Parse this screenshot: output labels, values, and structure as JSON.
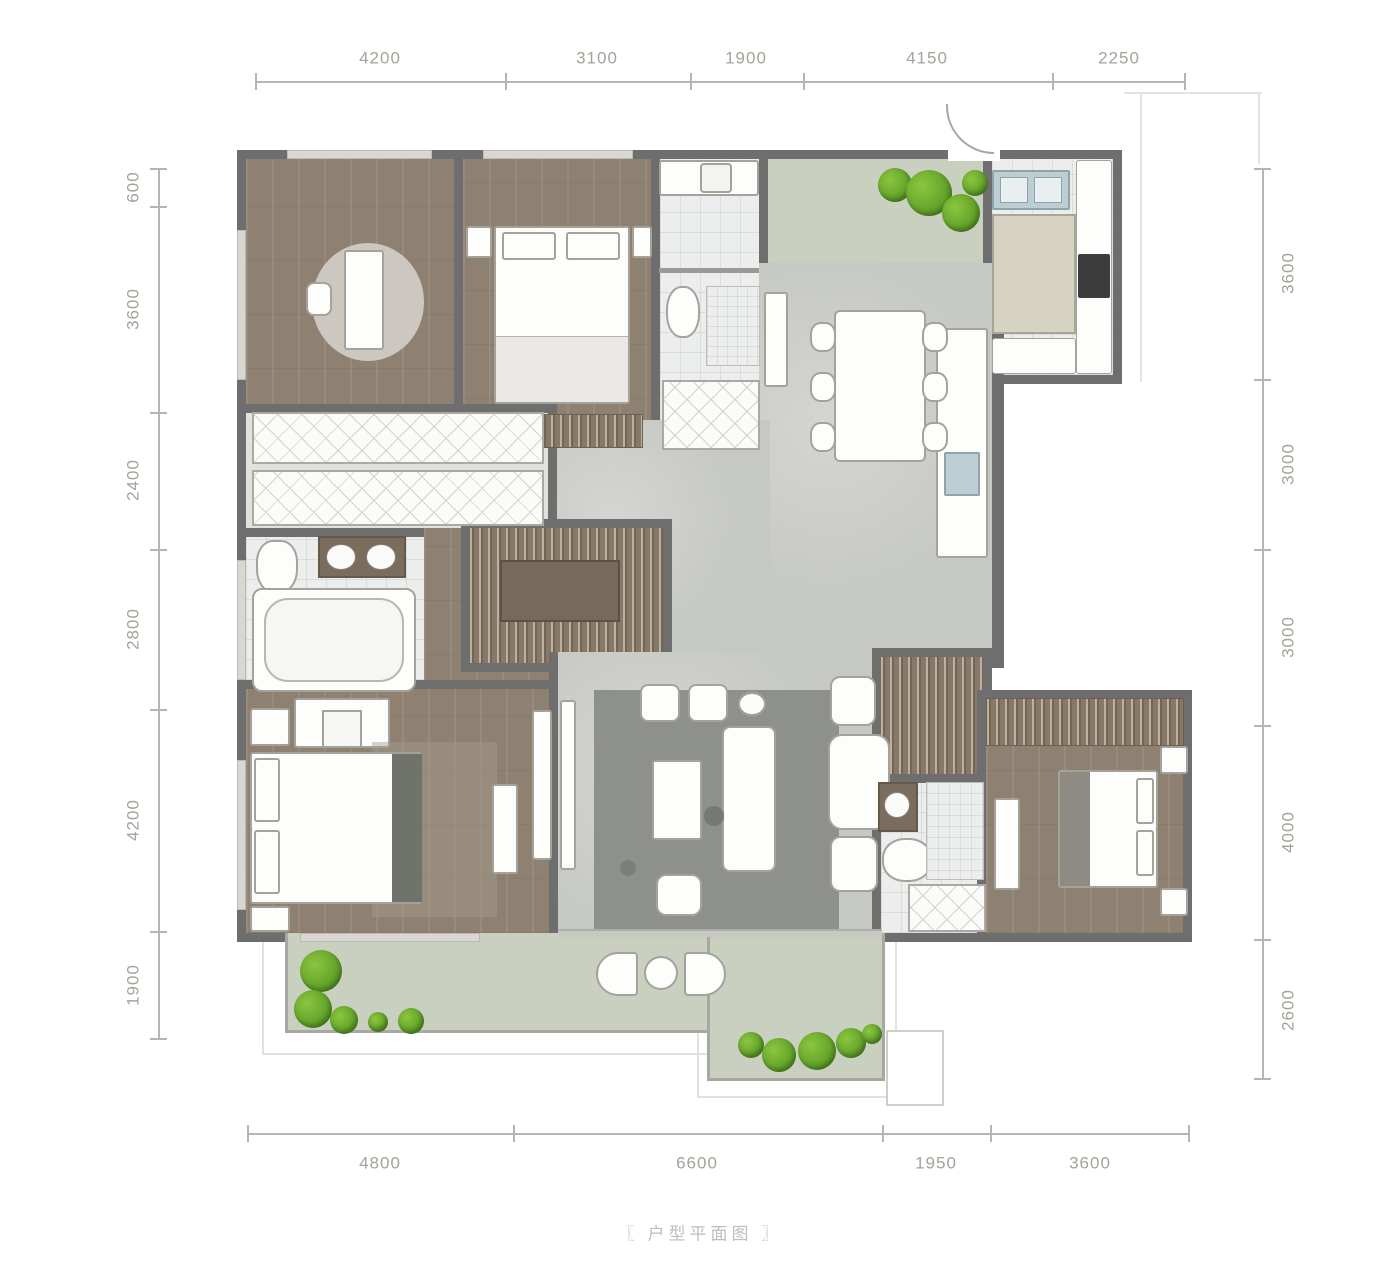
{
  "caption": "〖 户型平面图 〗",
  "dimensions": {
    "top": [
      "4200",
      "3100",
      "1900",
      "4150",
      "2250"
    ],
    "left": [
      "600",
      "3600",
      "2400",
      "2800",
      "4200",
      "1900"
    ],
    "right": [
      "3600",
      "3000",
      "3000",
      "4000",
      "2600"
    ],
    "bottom": [
      "4800",
      "6600",
      "1950",
      "3600"
    ]
  },
  "colors": {
    "wall": "#6e6e6e",
    "wood_floor": "#8f8172",
    "gray_floor": "#c6c8c3",
    "tile_floor": "#eceded",
    "courtyard_green": "#cad0bf",
    "plant_green": "#5d9e27",
    "closet_wood": "#877969",
    "rug_gray": "#8e918b",
    "counter_wood": "#7b6d5e",
    "sink_blue": "#bccdd4",
    "appliance_black": "#3c3c3c",
    "dimension_text": "#a5a29a",
    "caption_text": "#c3bcb4"
  }
}
